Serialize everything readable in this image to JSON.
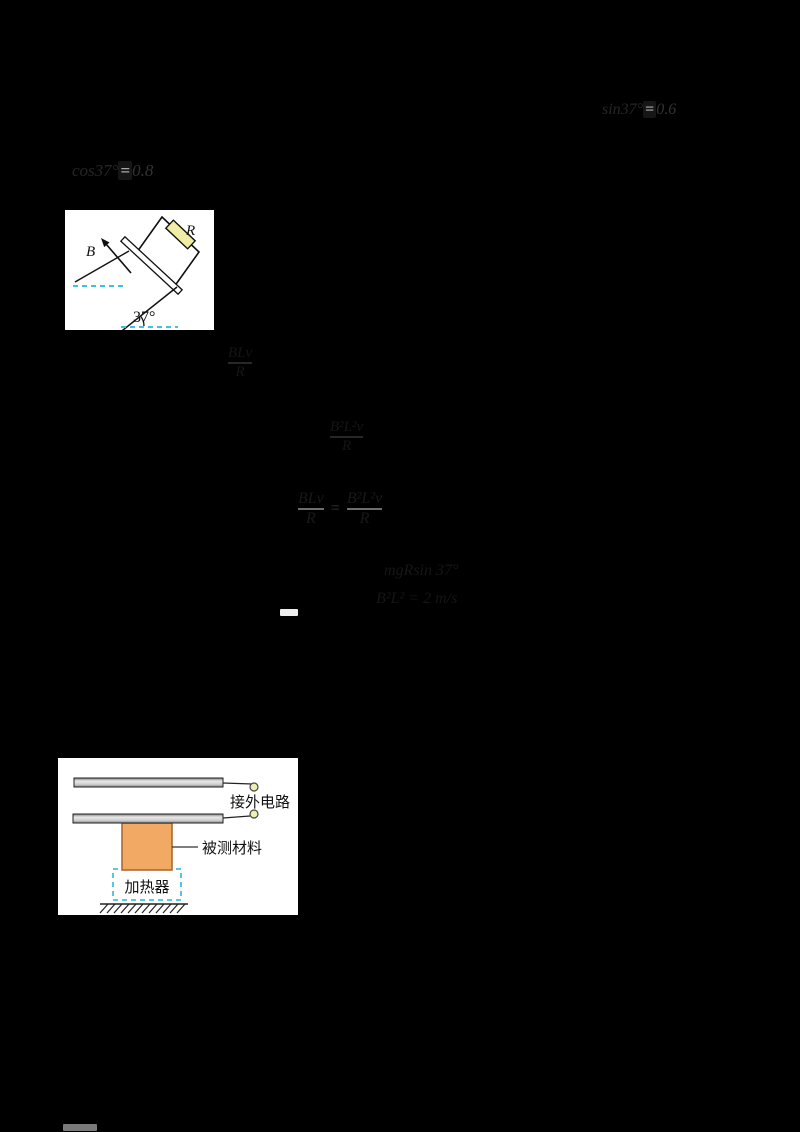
{
  "page": {
    "background": "#000000"
  },
  "faint_text": {
    "t1": {
      "prefix": "sin37°",
      "eq": "=",
      "value": "0.6"
    },
    "t2": {
      "prefix": "cos37°",
      "eq": "=",
      "value": "0.8"
    }
  },
  "formulas": {
    "f1": {
      "numerator": "BLv",
      "denominator": "R"
    },
    "f2": {
      "numerator": "B²L²v",
      "denominator": "R"
    },
    "f3": {
      "left_num": "BLv",
      "left_den": "R",
      "eq": "=",
      "right_num": "B²L²v",
      "right_den": "R"
    },
    "f4": {
      "line1": "mgRsin 37°",
      "line2": "B²L² = 2 m/s",
      "dash": "—"
    }
  },
  "figure1": {
    "labels": {
      "resistor": "R",
      "field": "B",
      "angle": "37°"
    },
    "colors": {
      "resistor_fill": "#f0eda6",
      "dashed": "#3fc0e4",
      "stroke": "#111111"
    }
  },
  "figure2": {
    "labels": {
      "external_circuit": "接外电路",
      "material": "被测材料",
      "heater": "加热器"
    },
    "colors": {
      "block_fill": "#f2a964",
      "block_stroke": "#a96a32",
      "dashed": "#45c0e0",
      "terminal_fill": "#eef0b2"
    }
  }
}
